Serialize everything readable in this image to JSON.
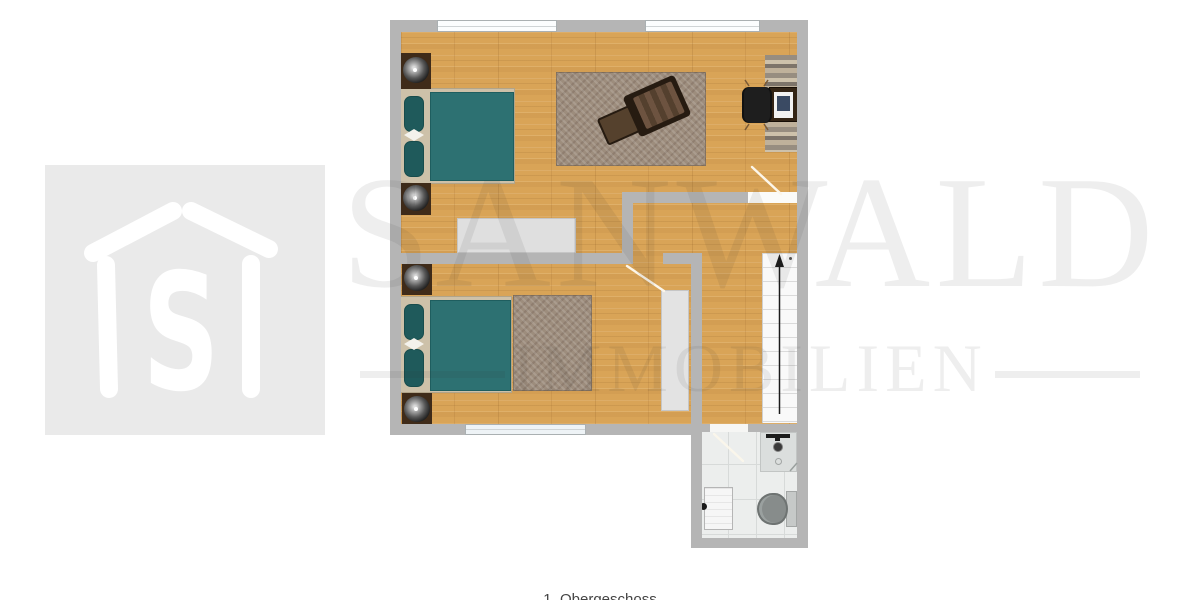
{
  "watermark": {
    "line1": "SANWALD",
    "line2": "IMMOBILIEN",
    "color": "rgba(47,47,47,0.082)"
  },
  "logo": {
    "monogram": "S",
    "description": "house-outline-logo",
    "bg": "#eaeaea"
  },
  "caption": {
    "text": "1. Obergeschoss"
  },
  "colors": {
    "wall": "#b5b5b5",
    "wood": "#d9a457",
    "blanket": "#2d7172",
    "pillow": "#1f5a5b",
    "headboard": "#cdc1a9",
    "rug": "#9d8d7d",
    "tile": "#eceeed",
    "tile_line": "#d7dad9",
    "stairs": "#f9f9f9",
    "window": "#fbfdfe",
    "logo_bg": "#eaeaea",
    "watermark": "rgba(47,47,47,0.082)"
  },
  "plan": {
    "rooms": [
      {
        "name": "bedroom-top",
        "furniture": [
          "double-bed",
          "bedside-lamp",
          "bedside-lamp",
          "wardrobe",
          "area-rug",
          "lounge-chair",
          "ottoman",
          "desk",
          "office-chair",
          "runner-rug"
        ]
      },
      {
        "name": "bedroom-bottom",
        "furniture": [
          "double-bed",
          "bedside-lamp",
          "bedside-lamp",
          "area-rug"
        ]
      },
      {
        "name": "hallway",
        "furniture": [
          "wardrobe",
          "staircase-up"
        ]
      },
      {
        "name": "bathroom",
        "furniture": [
          "shower",
          "toilet",
          "radiator"
        ]
      }
    ]
  }
}
